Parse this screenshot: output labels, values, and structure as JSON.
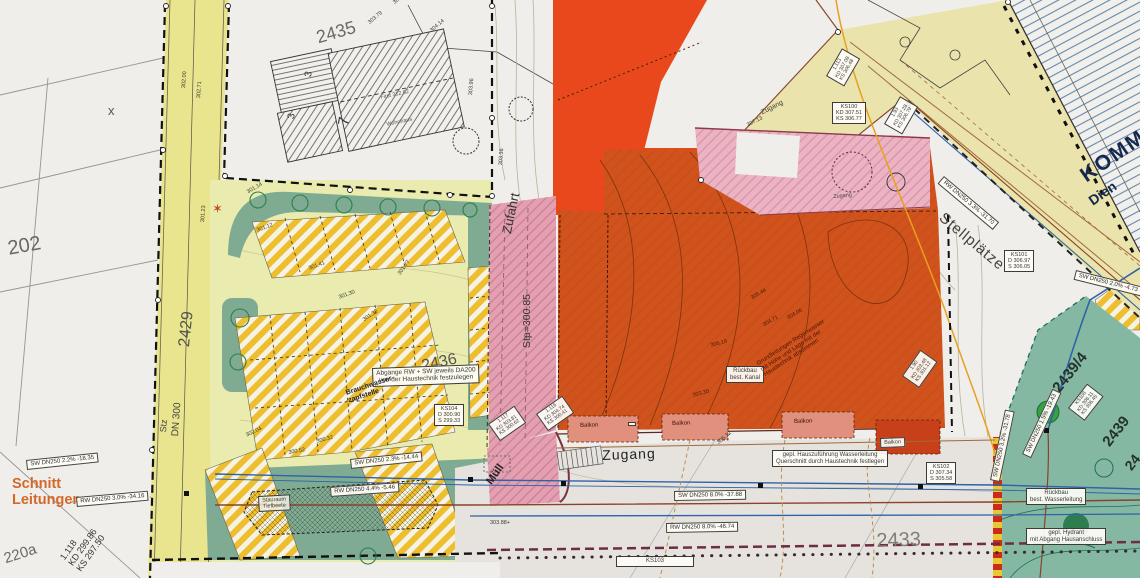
{
  "colors": {
    "paper": "#f0eeea",
    "road_yellow": "#e9e48e",
    "parcel_yellow": "#e9ecae",
    "landscape_green": "#7fab92",
    "stripe_yellow": "#edbe2e",
    "driveway_pink": "#e4a0b0",
    "building_pink": "#ecb3c3",
    "zone_vermilion": "#e8481b",
    "building_orange": "#d0521c",
    "road_grey": "#e6e3de",
    "green_area": "#84b8a3",
    "blue_pipe": "#2f62a8",
    "rw_pipe": "#8a4228",
    "orange_text": "#d4682a",
    "komm_blue": "#16294d"
  },
  "parcels": {
    "p202": "202",
    "p2429": "2429",
    "p2435": "2435",
    "p2436": "2436",
    "p2433": "2433",
    "p2439_4": "2439/4",
    "p2439": "2439",
    "p24": "24",
    "p220a": "220a"
  },
  "marks": {
    "x_mark": "x",
    "star": "✶"
  },
  "buildings": {
    "b3a": "3",
    "b3b": "3",
    "b7": "7",
    "first": "First 312.62",
    "wohnhaus": "Wohnhaus"
  },
  "areas": {
    "zufahrt": "Zufahrt",
    "stp": "Stp=300.85",
    "zugang": "Zugang",
    "zugang_top": "Zugang",
    "zugang_mid": "Zugang",
    "muell": "Müll",
    "stellplaetze": "Stellplätze",
    "stz": "Stz",
    "dn300": "DN 300",
    "komm": "KOMM",
    "dienst": "Dien",
    "schnitt": "Schnitt\nLeitungen",
    "balkon": "Balkon"
  },
  "annotations": {
    "abgaenge": "Abgänge RW + SW jeweils DA200\nvon der Haustechnik festzulegen",
    "brauchwasser": "Brauchwasser-\nzapfstelle",
    "stauraum": "Stauraum\nTiefbeete",
    "rueckbau_kanal": "Rückbau\nbest. Kanal",
    "rueckbau_wasser": "Rückbau\nbest. Wasserleitung",
    "hydrant": "gepl. Hydrant\nmit Abgang Hausanschluss",
    "hauszufuehrung": "gepl. Hauszuführung Wasserleitung\nQuerschnitt durch Haustechnik festlegen",
    "grundleitungen": "Grundleitungen Regenwasser\nmit Höhe und Lage mit der\nHaustechnik abstimmen",
    "l1118": "1.118\nKD 299.86\nKS 297.50"
  },
  "shafts": {
    "ks100": "KS100\nKD 307.51\nKS 306.77",
    "ks101": "KS101\nD 306.97\nS 306.05",
    "ks102": "KS102\nD 307.34\nS 305.58",
    "ks103": "KS103",
    "ks104": "KS104\nD 300.90\nS 299.33",
    "ks108": "KS108\nKD 306.11\nKS 306.45",
    "s1117": "1.117\nKD 303.81\nKS 300.62",
    "s1116": "1.116\nKD 304.74\nKS 300.41",
    "s1113": "1.113\nKD 307.08\nKS 306.48",
    "s193": "1.93\nKD 307.28\nKS 306.79",
    "s190": "1.90\nKD 303.48\nKS 301.12"
  },
  "pipes": {
    "sw1": "SW DN250  2.2%  -18.35",
    "rw1": "RW DN250  3.0%  -34.16",
    "sw2": "SW DN250  2.3%  -14.44",
    "rw2": "RW DN250  4.4%  -5.46",
    "sw3": "SW DN250  8.0%  -37.88",
    "rw3": "RW DN250  8.0%  -46.74",
    "rw4": "RW DN250  3.3%  -31.70",
    "sw4": "SW DN250  2.0%  -4.73",
    "sw5": "SW DN250  3.2%  -31.78",
    "tw1": "SW DN250  1.5%  -19.43"
  },
  "elevations": {
    "e30141": "301.41",
    "e30130": "301.30",
    "e30132": "301.32",
    "e30177": "301.77",
    "e30112": "301.12",
    "e30114": "301.14",
    "e30204": "302.04",
    "e30052": "300.52",
    "e30032": "300.32",
    "e30388": "303.88+",
    "e30619": "306.19",
    "e30471": "304.71",
    "e30406": "304.06",
    "e30544": "305.44",
    "e30330": "303.30",
    "e30421": "304.21",
    "e30379": "303.79",
    "e30414": "304.14",
    "e30396": "303.96",
    "e30336": "303.36",
    "e30612": "306.12",
    "e30713": "307.13",
    "e30200": "302.00",
    "e30271": "302.71",
    "e30123": "301.23"
  }
}
